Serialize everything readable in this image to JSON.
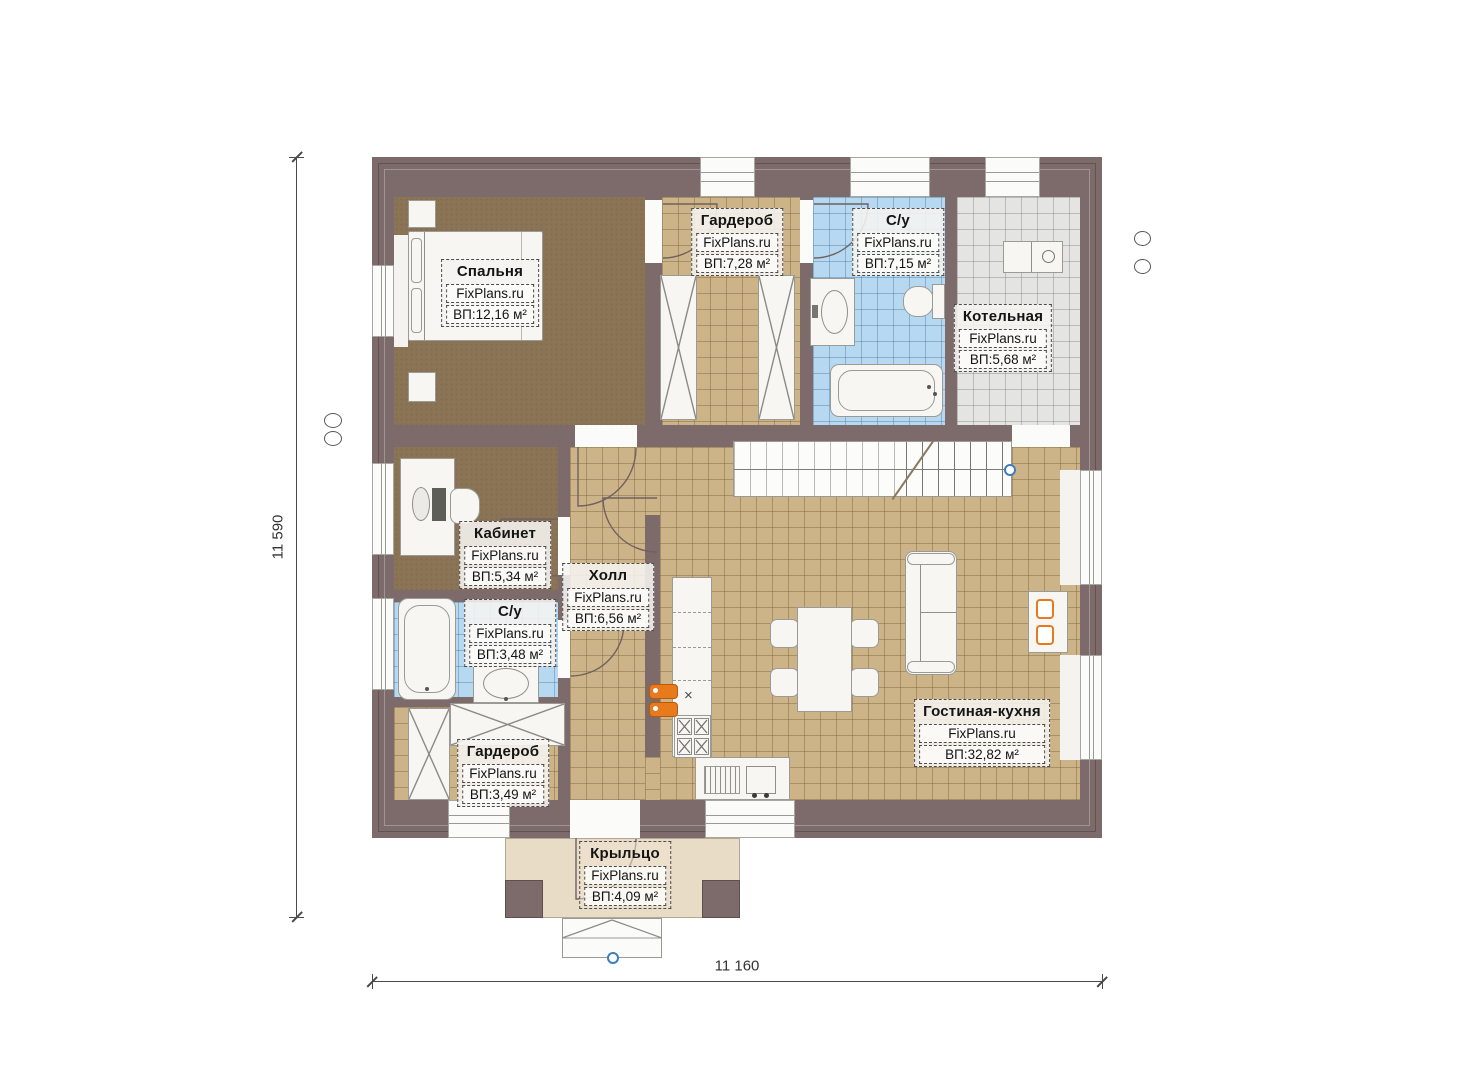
{
  "plan": {
    "brand": "FixPlans.ru",
    "dimensions": {
      "horizontal": "11 160",
      "vertical": "11 590"
    },
    "rooms": [
      {
        "key": "bedroom",
        "name": "Спальня",
        "brand": "FixPlans.ru",
        "area": "ВП:12,16 м²"
      },
      {
        "key": "wardrobe-top",
        "name": "Гардероб",
        "brand": "FixPlans.ru",
        "area": "ВП:7,28 м²"
      },
      {
        "key": "bathroom-top",
        "name": "С/у",
        "brand": "FixPlans.ru",
        "area": "ВП:7,15 м²"
      },
      {
        "key": "boiler-room",
        "name": "Котельная",
        "brand": "FixPlans.ru",
        "area": "ВП:5,68 м²"
      },
      {
        "key": "office",
        "name": "Кабинет",
        "brand": "FixPlans.ru",
        "area": "ВП:5,34 м²"
      },
      {
        "key": "hall",
        "name": "Холл",
        "brand": "FixPlans.ru",
        "area": "ВП:6,56 м²"
      },
      {
        "key": "bathroom-small",
        "name": "С/у",
        "brand": "FixPlans.ru",
        "area": "ВП:3,48 м²"
      },
      {
        "key": "wardrobe-bottom",
        "name": "Гардероб",
        "brand": "FixPlans.ru",
        "area": "ВП:3,49 м²"
      },
      {
        "key": "living-kitchen",
        "name": "Гостиная-кухня",
        "brand": "FixPlans.ru",
        "area": "ВП:32,82 м²"
      },
      {
        "key": "porch",
        "name": "Крыльцо",
        "brand": "FixPlans.ru",
        "area": "ВП:4,09 м²"
      }
    ],
    "kitchen": {
      "sink_symbol": "×"
    },
    "colors": {
      "wall": "#7d6b6b",
      "bedroom_floor": "#8b7456",
      "tile_tan": "#cdb488",
      "tile_blue": "#b7d8f1",
      "tile_gray": "#e4e4e2",
      "porch_floor": "#e8dcc6",
      "accent_orange": "#e8791c"
    }
  }
}
